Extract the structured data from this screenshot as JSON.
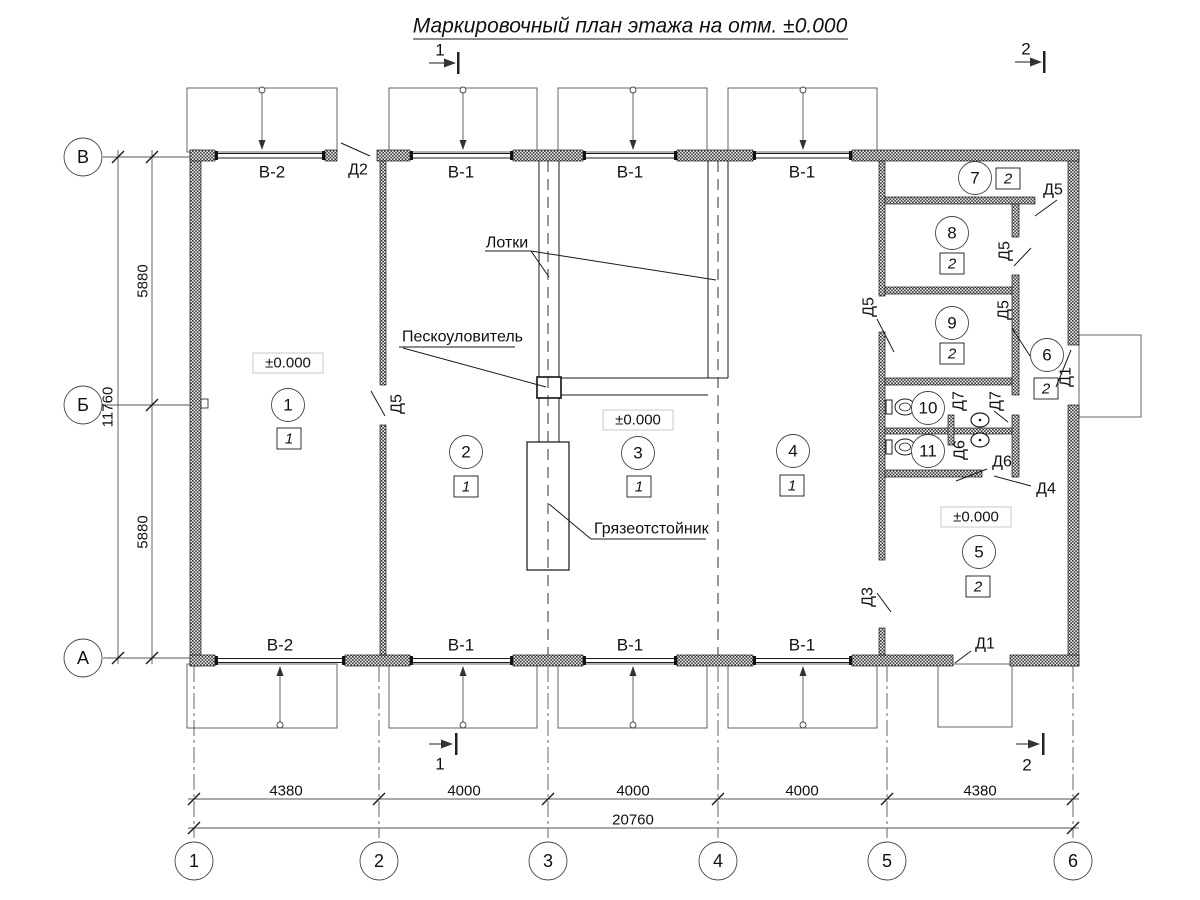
{
  "title": "Маркировочный план этажа на отм. ±0.000",
  "section_marks": {
    "top_1": "1",
    "top_2": "2",
    "bottom_1": "1",
    "bottom_2": "2"
  },
  "grid": {
    "row_axes": [
      "В",
      "Б",
      "А"
    ],
    "col_axes": [
      "1",
      "2",
      "3",
      "4",
      "5",
      "6"
    ]
  },
  "dimensions": {
    "vertical": [
      "5880",
      "5880"
    ],
    "vertical_total": "11760",
    "horizontal": [
      "4380",
      "4000",
      "4000",
      "4000",
      "4380"
    ],
    "horizontal_total": "20760"
  },
  "windows": {
    "top": [
      "В-2",
      "В-1",
      "В-1",
      "В-1"
    ],
    "bottom": [
      "В-2",
      "В-1",
      "В-1",
      "В-1"
    ]
  },
  "door_labels": {
    "d2": "Д2",
    "d5_room1": "Д5",
    "d5_room7": "Д5",
    "d5_room8": "Д5",
    "d5_room9_left": "Д5",
    "d5_room9_right": "Д5",
    "d7_left": "Д7",
    "d7_right": "Д7",
    "d6_left": "Д6",
    "d6_right": "Д6",
    "d4": "Д4",
    "d3": "Д3",
    "d1_room6": "Д1",
    "d1_bottom": "Д1"
  },
  "rooms": [
    {
      "number": "1",
      "category": "1"
    },
    {
      "number": "2",
      "category": "1"
    },
    {
      "number": "3",
      "category": "1"
    },
    {
      "number": "4",
      "category": "1"
    },
    {
      "number": "5",
      "category": "2"
    },
    {
      "number": "6",
      "category": "2"
    },
    {
      "number": "7",
      "category": "2"
    },
    {
      "number": "8",
      "category": "2"
    },
    {
      "number": "9",
      "category": "2"
    },
    {
      "number": "10"
    },
    {
      "number": "11"
    }
  ],
  "elevation_marks": {
    "room1": "±0.000",
    "room3": "±0.000",
    "room5": "±0.000"
  },
  "annotations": {
    "trays": "Лотки",
    "sand_trap": "Пескоуловитель",
    "mud_settler": "Грязеотстойник"
  },
  "colors": {
    "line": "#1a1a1a",
    "background": "#ffffff"
  }
}
